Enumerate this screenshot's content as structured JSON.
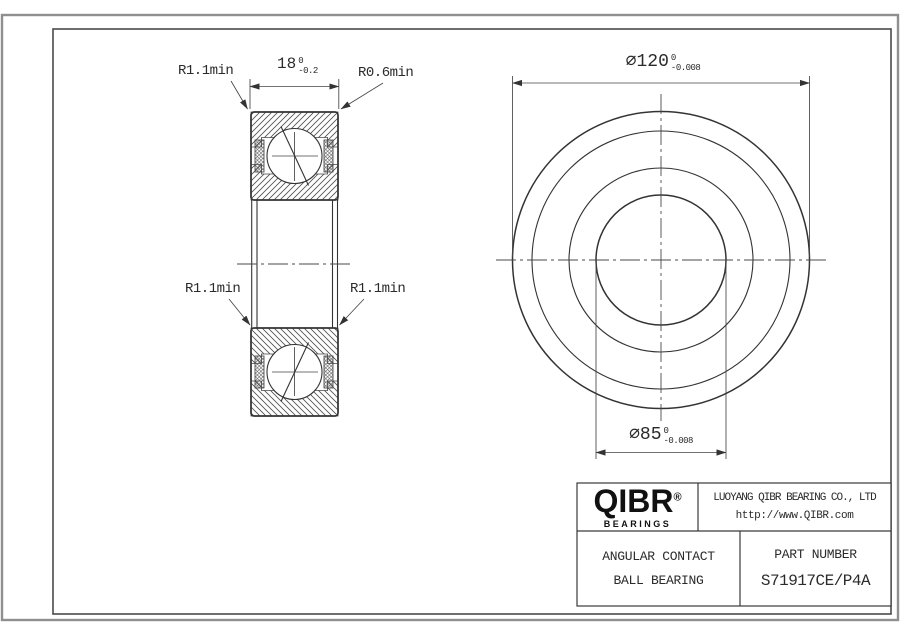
{
  "colors": {
    "line": "#333333",
    "border_outer": "#8f8f8f",
    "border_inner": "#4a4a4a",
    "text": "#2b2b2b"
  },
  "dimensions": {
    "width": {
      "value": "18",
      "tol_upper": "0",
      "tol_lower": "-0.2"
    },
    "outer_diameter": {
      "value": "∅120",
      "tol_upper": "0",
      "tol_lower": "-0.008"
    },
    "bore_diameter": {
      "value": "∅85",
      "tol_upper": "0",
      "tol_lower": "-0.008"
    },
    "radius_top_left": "R1.1min",
    "radius_top_right": "R0.6min",
    "radius_bottom_left": "R1.1min",
    "radius_bottom_right": "R1.1min"
  },
  "title_block": {
    "logo": {
      "brand": "QIBR",
      "registered": "®",
      "tagline": "BEARINGS"
    },
    "company_name": "LUOYANG QIBR BEARING CO., LTD",
    "website": "http://www.QIBR.com",
    "product_type_line1": "ANGULAR CONTACT",
    "product_type_line2": "BALL BEARING",
    "part_number_label": "PART NUMBER",
    "part_number_value": "S71917CE/P4A"
  }
}
